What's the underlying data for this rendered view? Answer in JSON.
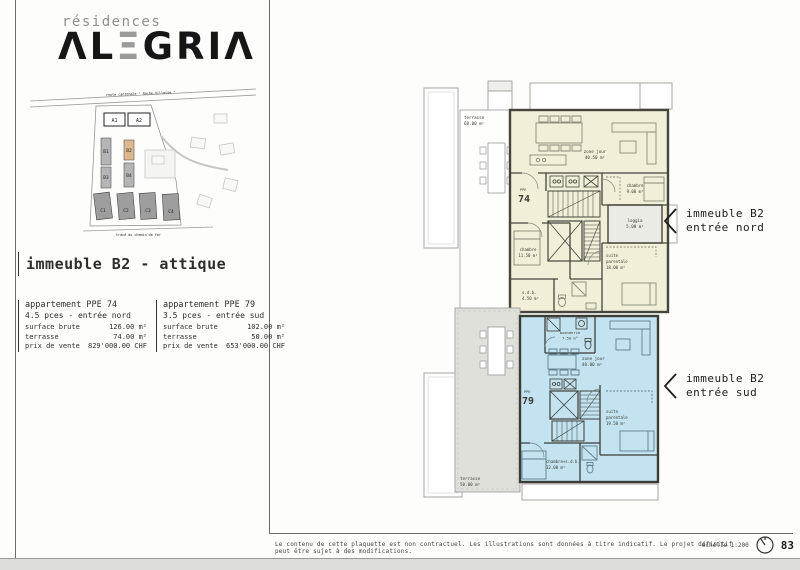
{
  "logo": {
    "subtitle": "résidences",
    "main_part1": "ΛL",
    "main_e": "Ξ",
    "main_part2": "GRIΛ"
  },
  "site_map": {
    "road_top": "route cantonale \" Roche-Villette \"",
    "road_bottom": "tracé du chemin de fer",
    "buildings": [
      "A1",
      "A2",
      "B1",
      "B2",
      "B3",
      "B4",
      "C1",
      "C2",
      "C3",
      "C4"
    ],
    "highlight_color": "#ddb88f"
  },
  "section_title": "immeuble B2 - attique",
  "apartments": [
    {
      "name": "appartement PPE 74",
      "pces": "4.5 pces - entrée nord",
      "rows": [
        {
          "label": "surface brute",
          "value": "126.00 m²"
        },
        {
          "label": "terrasse",
          "value": "74.00 m²"
        },
        {
          "label": "prix de vente",
          "value": "829'000.00 CHF"
        }
      ]
    },
    {
      "name": "appartement PPE 79",
      "pces": "3.5 pces - entrée sud",
      "rows": [
        {
          "label": "surface brute",
          "value": "102.00 m²"
        },
        {
          "label": "terrasse",
          "value": "50.00 m²"
        },
        {
          "label": "prix de vente",
          "value": "653'000.00 CHF"
        }
      ]
    }
  ],
  "plan": {
    "colors": {
      "apt74_fill": "#f2efd8",
      "apt79_fill": "#c3e3f0",
      "wall": "#45453c"
    },
    "apt74": {
      "ppe": "PPE",
      "num": "74",
      "terrasse": "terrasse",
      "terrasse_area": "68.00 m²",
      "zone": "zone jour",
      "zone_area": "40.50 m²",
      "chambre1": "chambre",
      "chambre1_area": "9.00 m²",
      "loggia": "loggia",
      "loggia_area": "5.00 m²",
      "chambre2": "chambre",
      "chambre2_area": "11.50 m²",
      "suite1": "suite",
      "suite2": "parentale",
      "suite_area": "18.00 m²",
      "sdb": "s.d.b.",
      "sdb_area": "4.50 m²"
    },
    "apt79": {
      "ppe": "PPE",
      "num": "79",
      "buanderie": "buanderie",
      "buanderie_area": "7.50 m²",
      "zone": "zone jour",
      "zone_area": "40.00 m²",
      "suite1": "suite",
      "suite2": "parentale",
      "suite_area": "19.50 m²",
      "chambre": "chambre+s.d.b.",
      "chambre_area": "12.00 m²",
      "terrasse": "terrasse",
      "terrasse_area": "50.00 m²"
    }
  },
  "annotations": {
    "nord": {
      "line1": "immeuble B2",
      "line2": "entrée nord"
    },
    "sud": {
      "line1": "immeuble B2",
      "line2": "entrée sud"
    }
  },
  "footer": {
    "disclaimer": "Le contenu de cette plaquette est non contractuel. Les illustrations sont données à titre indicatif. Le projet définitif peut être sujet à des modifications.",
    "scale": "échelle 1:200",
    "page": "83"
  }
}
